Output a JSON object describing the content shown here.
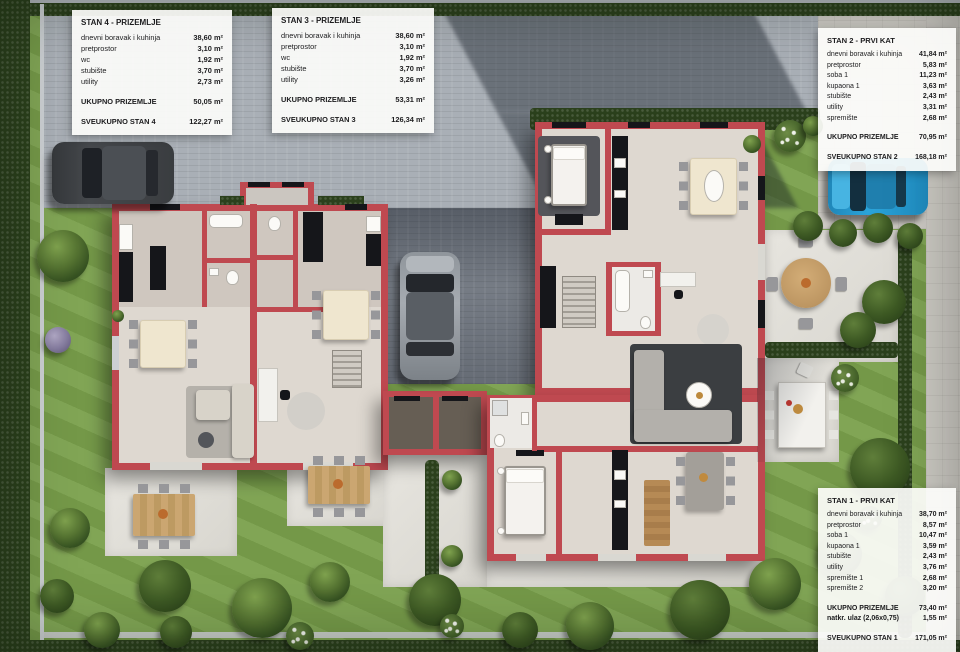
{
  "colors": {
    "wall": "#bf4950",
    "floor": "#ded8d0",
    "floor_grey": "#cbc6c0",
    "grass": "#7aa04c",
    "hedge": "#2b401c",
    "paving": "#a9afb6",
    "paving_dark": "#7f858e",
    "slabs": "#cdcac4",
    "black_fixture": "#15161a",
    "car_blue": "#2ba4da",
    "car_dark": "#3b3e41",
    "car_grey": "#989da3",
    "text": "#1c1c1e"
  },
  "panels": [
    {
      "id": "stan-4",
      "title": "STAN 4 - PRIZEMLJE",
      "rows": [
        {
          "label": "dnevni boravak i kuhinja",
          "value": "38,60 m²"
        },
        {
          "label": "pretprostor",
          "value": "3,10 m²"
        },
        {
          "label": "wc",
          "value": "1,92 m²"
        },
        {
          "label": "stubište",
          "value": "3,70 m²"
        },
        {
          "label": "utility",
          "value": "2,73 m²"
        }
      ],
      "subtotal": [
        {
          "label": "UKUPNO PRIZEMLJE",
          "value": "50,05 m²"
        }
      ],
      "total": {
        "label": "SVEUKUPNO STAN 4",
        "value": "122,27 m²"
      }
    },
    {
      "id": "stan-3",
      "title": "STAN 3 - PRIZEMLJE",
      "rows": [
        {
          "label": "dnevni boravak i kuhinja",
          "value": "38,60 m²"
        },
        {
          "label": "pretprostor",
          "value": "3,10 m²"
        },
        {
          "label": "wc",
          "value": "1,92 m²"
        },
        {
          "label": "stubište",
          "value": "3,70 m²"
        },
        {
          "label": "utility",
          "value": "3,26 m²"
        }
      ],
      "subtotal": [
        {
          "label": "UKUPNO PRIZEMLJE",
          "value": "53,31 m²"
        }
      ],
      "total": {
        "label": "SVEUKUPNO STAN 3",
        "value": "126,34 m²"
      }
    },
    {
      "id": "stan-2",
      "title": "STAN 2 - PRVI KAT",
      "rows": [
        {
          "label": "dnevni boravak i kuhinja",
          "value": "41,84 m²"
        },
        {
          "label": "pretprostor",
          "value": "5,83 m²"
        },
        {
          "label": "soba 1",
          "value": "11,23 m²"
        },
        {
          "label": "kupaona 1",
          "value": "3,63 m²"
        },
        {
          "label": "stubište",
          "value": "2,43 m²"
        },
        {
          "label": "utility",
          "value": "3,31 m²"
        },
        {
          "label": "spremište",
          "value": "2,68 m²"
        }
      ],
      "subtotal": [
        {
          "label": "UKUPNO PRIZEMLJE",
          "value": "70,95 m²"
        }
      ],
      "total": {
        "label": "SVEUKUPNO STAN 2",
        "value": "168,18 m²"
      }
    },
    {
      "id": "stan-1",
      "title": "STAN 1 - PRVI KAT",
      "rows": [
        {
          "label": "dnevni boravak i kuhinja",
          "value": "38,70 m²"
        },
        {
          "label": "pretprostor",
          "value": "8,57 m²"
        },
        {
          "label": "soba 1",
          "value": "10,47 m²"
        },
        {
          "label": "kupaona 1",
          "value": "3,59 m²"
        },
        {
          "label": "stubište",
          "value": "2,43 m²"
        },
        {
          "label": "utility",
          "value": "3,76 m²"
        },
        {
          "label": "spremište 1",
          "value": "2,68 m²"
        },
        {
          "label": "spremište 2",
          "value": "3,20 m²"
        }
      ],
      "subtotal": [
        {
          "label": "UKUPNO PRIZEMLJE",
          "value": "73,40 m²"
        },
        {
          "label": "natkr. ulaz (2,06x0,75)",
          "value": "1,55 m²"
        }
      ],
      "total": {
        "label": "SVEUKUPNO STAN 1",
        "value": "171,05 m²"
      }
    }
  ]
}
